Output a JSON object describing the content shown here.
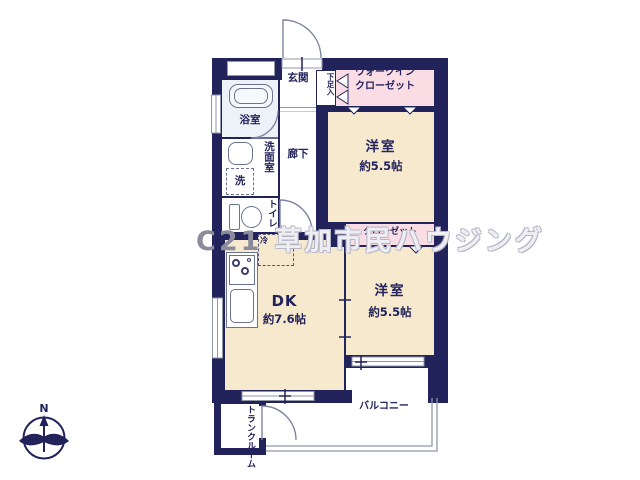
{
  "plan": {
    "watermark": {
      "brand": "C21",
      "company": "草加市民ハウジング"
    },
    "compass": {
      "north": "N"
    },
    "labels": {
      "genkan": "玄関",
      "shoebox": "下足入",
      "wic1": "ウォークイン",
      "wic2": "クローゼット",
      "bath": "浴室",
      "washroom": "洗面室",
      "laundry": "洗",
      "toilet": "トイレ",
      "corridor": "廊下",
      "fridge": "冷",
      "bedroom1": "洋室",
      "bedroom1_size": "約5.5帖",
      "closet": "クローゼット",
      "bedroom2": "洋室",
      "bedroom2_size": "約5.5帖",
      "dk": "DK",
      "dk_size": "約7.6帖",
      "trunk1": "トランク",
      "trunk2": "ルーム",
      "balcony": "バルコニー"
    },
    "colors": {
      "wall": "#23235c",
      "room_cream": "#f7e9cd",
      "closet_pink": "#f9dce4",
      "bath_blue": "#edf2f8",
      "fixture_line": "#6a7390",
      "watermark_gray": "#8b8b9c"
    }
  }
}
